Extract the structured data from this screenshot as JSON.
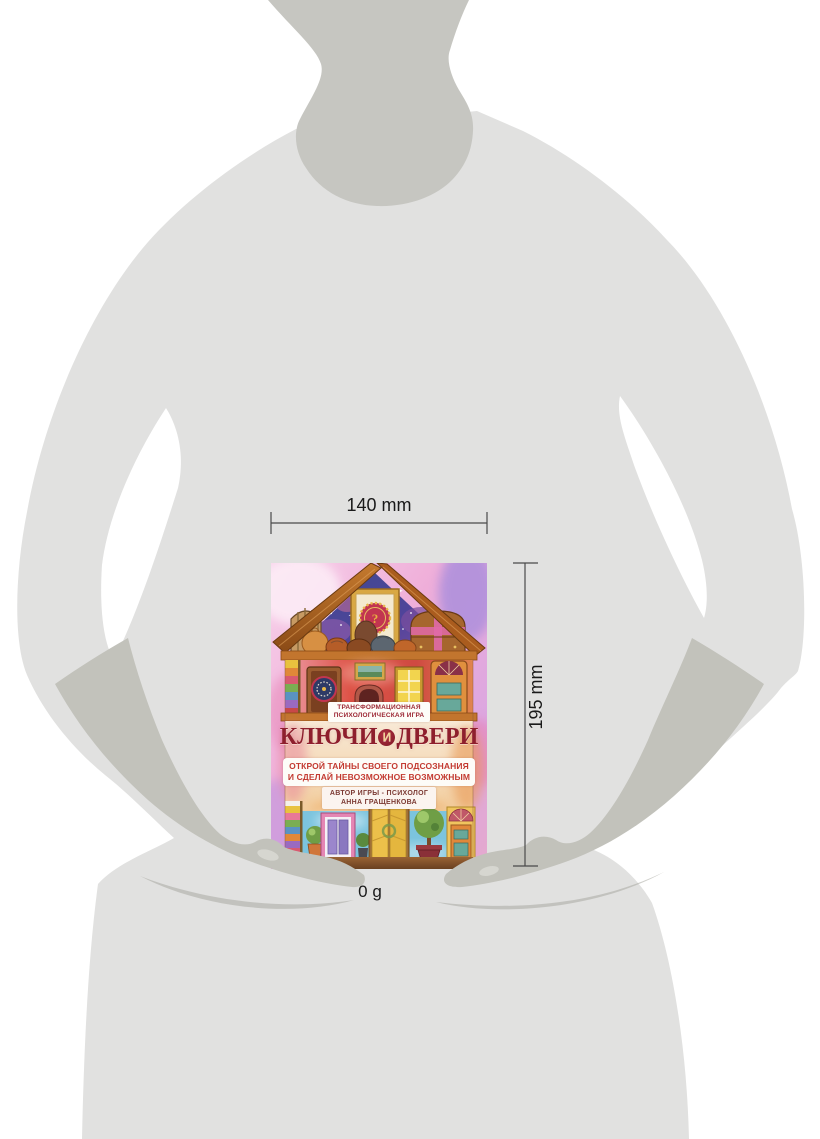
{
  "product": {
    "badge_line1": "ТРАНСФОРМАЦИОННАЯ",
    "badge_line2": "ПСИХОЛОГИЧЕСКАЯ ИГРА",
    "title_word1": "КЛЮЧИ",
    "title_conjunction": "И",
    "title_word2": "ДВЕРИ",
    "subtitle_line1": "ОТКРОЙ ТАЙНЫ СВОЕГО ПОДСОЗНАНИЯ",
    "subtitle_line2": "И СДЕЛАЙ НЕВОЗМОЖНОЕ ВОЗМОЖНЫМ",
    "author_line1": "АВТОР ИГРЫ - ПСИХОЛОГ",
    "author_line2": "АННА ГРАЩЕНКОВА",
    "gable_question_mark": "?"
  },
  "dimensions": {
    "width_label": "140 mm",
    "height_label": "195 mm",
    "weight_label": "0 g"
  },
  "colors": {
    "background": "#ffffff",
    "body_silhouette": "#e1e1e0",
    "neck_silhouette": "#c6c6c1",
    "hands_silhouette": "#c2c2bb",
    "hand_shadow": "#aaaaa3",
    "dimension_line": "#4a4a4a",
    "label_text": "#1a1a1a",
    "badge_red": "#9c2733",
    "title_red": "#8e1f2d",
    "subtitle_red": "#c33a31",
    "author_brown": "#7c3a33"
  }
}
